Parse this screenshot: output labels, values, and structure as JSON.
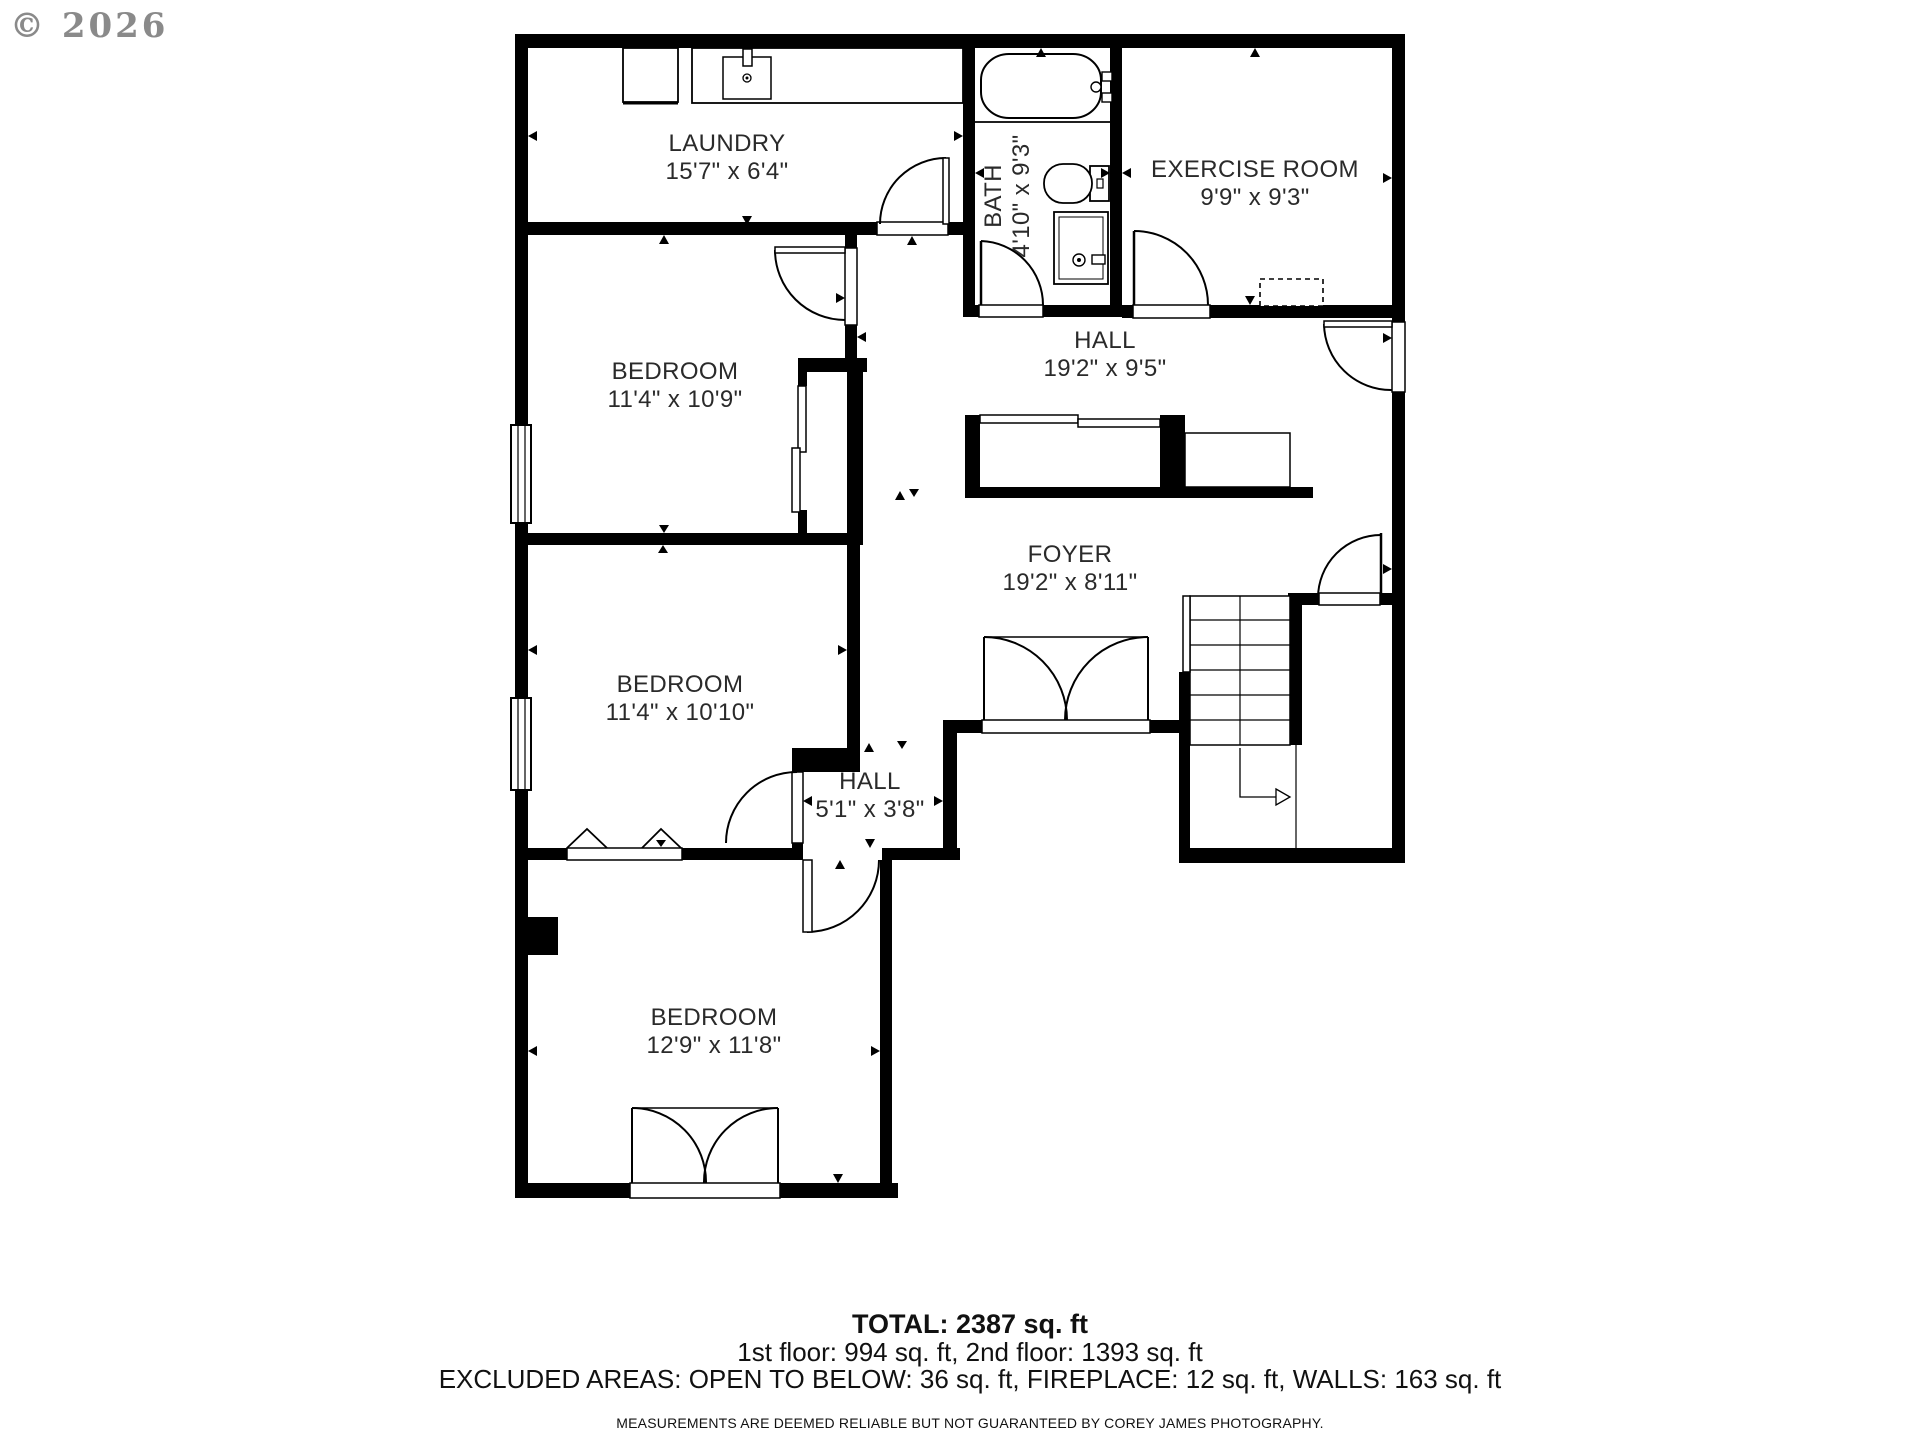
{
  "watermark": "© 2026",
  "rooms": [
    {
      "id": "laundry",
      "name": "LAUNDRY",
      "dims": "15'7\" x 6'4\""
    },
    {
      "id": "bath",
      "name": "BATH",
      "dims": "4'10\" x 9'3\""
    },
    {
      "id": "exercise-room",
      "name": "EXERCISE ROOM",
      "dims": "9'9\" x 9'3\""
    },
    {
      "id": "hall-upper",
      "name": "HALL",
      "dims": "19'2\" x 9'5\""
    },
    {
      "id": "bedroom-1",
      "name": "BEDROOM",
      "dims": "11'4\" x 10'9\""
    },
    {
      "id": "foyer",
      "name": "FOYER",
      "dims": "19'2\" x 8'11\""
    },
    {
      "id": "bedroom-2",
      "name": "BEDROOM",
      "dims": "11'4\" x 10'10\""
    },
    {
      "id": "hall-small",
      "name": "HALL",
      "dims": "5'1\" x 3'8\""
    },
    {
      "id": "bedroom-3",
      "name": "BEDROOM",
      "dims": "12'9\" x 11'8\""
    }
  ],
  "summary": {
    "total": "TOTAL: 2387 sq. ft",
    "floors": "1st floor: 994 sq. ft, 2nd floor: 1393 sq. ft",
    "excluded": "EXCLUDED AREAS: OPEN TO BELOW: 36 sq. ft, FIREPLACE: 12 sq. ft, WALLS: 163 sq. ft",
    "disclaimer": "MEASUREMENTS ARE DEEMED RELIABLE BUT NOT GUARANTEED BY COREY JAMES PHOTOGRAPHY."
  },
  "colors": {
    "wall": "#000000",
    "label_text": "#2a2a2a",
    "watermark": "#8a8a8a"
  }
}
